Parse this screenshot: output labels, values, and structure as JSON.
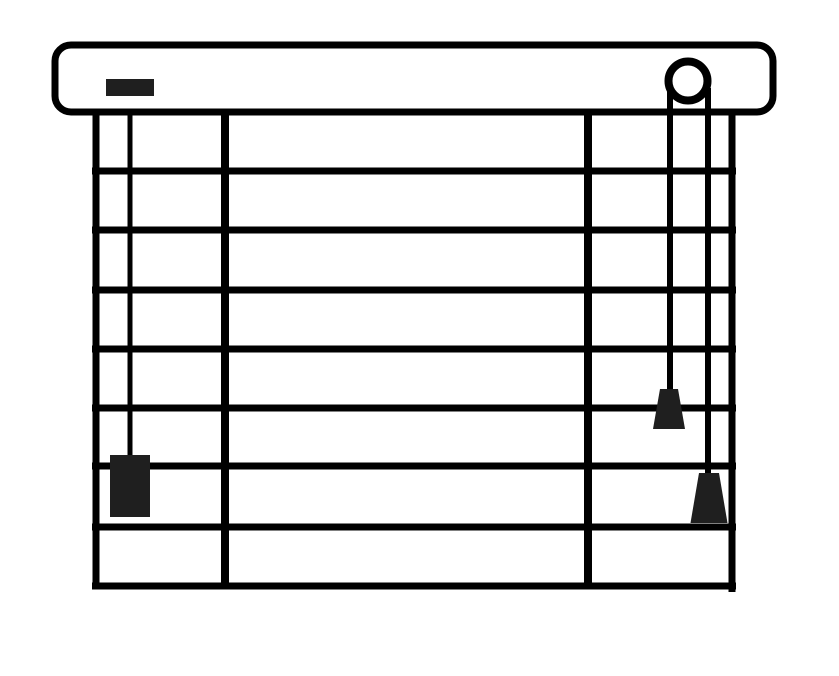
{
  "canvas": {
    "width": 839,
    "height": 676,
    "background": "#ffffff"
  },
  "palette": {
    "line": "#000000",
    "dark_fill": "#1f1f1f",
    "surface": "#ffffff"
  },
  "illustration": {
    "label": "venetian-blind-line-drawing",
    "headrail": {
      "x": 55,
      "y": 45,
      "width": 718,
      "height": 67,
      "corner_radius": 16,
      "stroke_width": 7
    },
    "brand_block": {
      "x": 106,
      "y": 79,
      "width": 48,
      "height": 17
    },
    "cord_lock": {
      "cx": 688,
      "cy": 81,
      "radius": 19.5,
      "ring_width": 8
    },
    "frame": {
      "left_x": 96,
      "right_x": 732,
      "top_y": 110,
      "bottom_y": 586,
      "left_bottom_overhang": 3,
      "right_bottom_overhang": 6,
      "stroke_width": 7,
      "span_x1": 92,
      "span_x2": 736
    },
    "slat_rows": 8,
    "slat_lines_y": [
      171,
      230,
      290,
      349,
      408,
      466,
      527
    ],
    "ladder_tapes_x": [
      225,
      588
    ],
    "ladder_stroke_width": 8,
    "tilt_wand": {
      "x": 130,
      "top_y": 112,
      "bottom_y": 459,
      "stroke_width": 5,
      "handle": {
        "x": 110,
        "y": 455,
        "width": 40,
        "height": 62
      }
    },
    "lift_cords": [
      {
        "x": 670,
        "top_y": 88,
        "bottom_y": 391,
        "stroke_width": 6,
        "tassel": {
          "center_x": 669,
          "top_y": 389,
          "top_width": 18,
          "bottom_y": 429,
          "bottom_width": 32
        }
      },
      {
        "x": 708,
        "top_y": 88,
        "bottom_y": 475,
        "stroke_width": 6,
        "tassel": {
          "center_x": 709,
          "top_y": 473,
          "top_width": 20,
          "bottom_y": 523,
          "bottom_width": 37
        }
      }
    ]
  }
}
